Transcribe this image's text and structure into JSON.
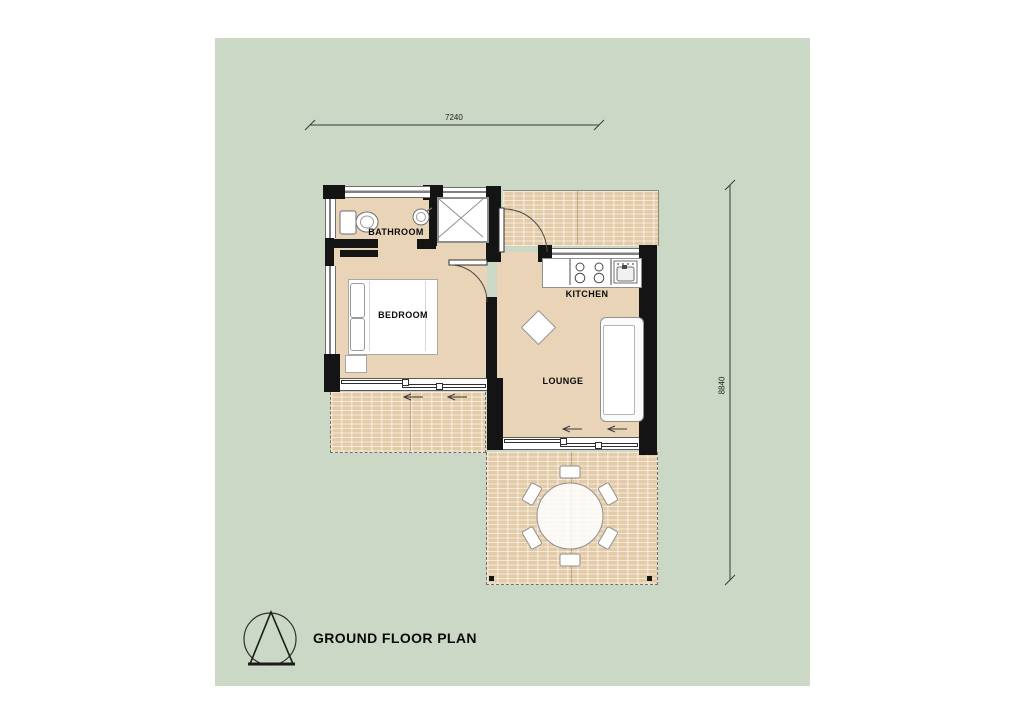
{
  "title": {
    "text": "GROUND FLOOR PLAN"
  },
  "logo": {
    "name": "triangle-in-circle-logo"
  },
  "rooms": {
    "bathroom": {
      "label": "BATHROOM"
    },
    "bedroom": {
      "label": "BEDROOM"
    },
    "kitchen": {
      "label": "KITCHEN"
    },
    "lounge": {
      "label": "LOUNGE"
    }
  },
  "dimensions": {
    "horizontal": "7240",
    "vertical": "8840"
  },
  "colors": {
    "site_green": "#cbd8c5",
    "floor_tan": "#e9d4b8",
    "terrace_tan": "#e4cba8",
    "wall_black": "#141414",
    "line_gray": "#555555"
  },
  "furniture_icons": [
    "bed-icon",
    "pillow-icon",
    "toilet-icon",
    "basin-icon",
    "shower-icon",
    "stove-icon",
    "kitchen-sink-icon",
    "counter-icon",
    "sofa-icon",
    "side-table-icon",
    "dining-table-icon",
    "chair-icon"
  ]
}
